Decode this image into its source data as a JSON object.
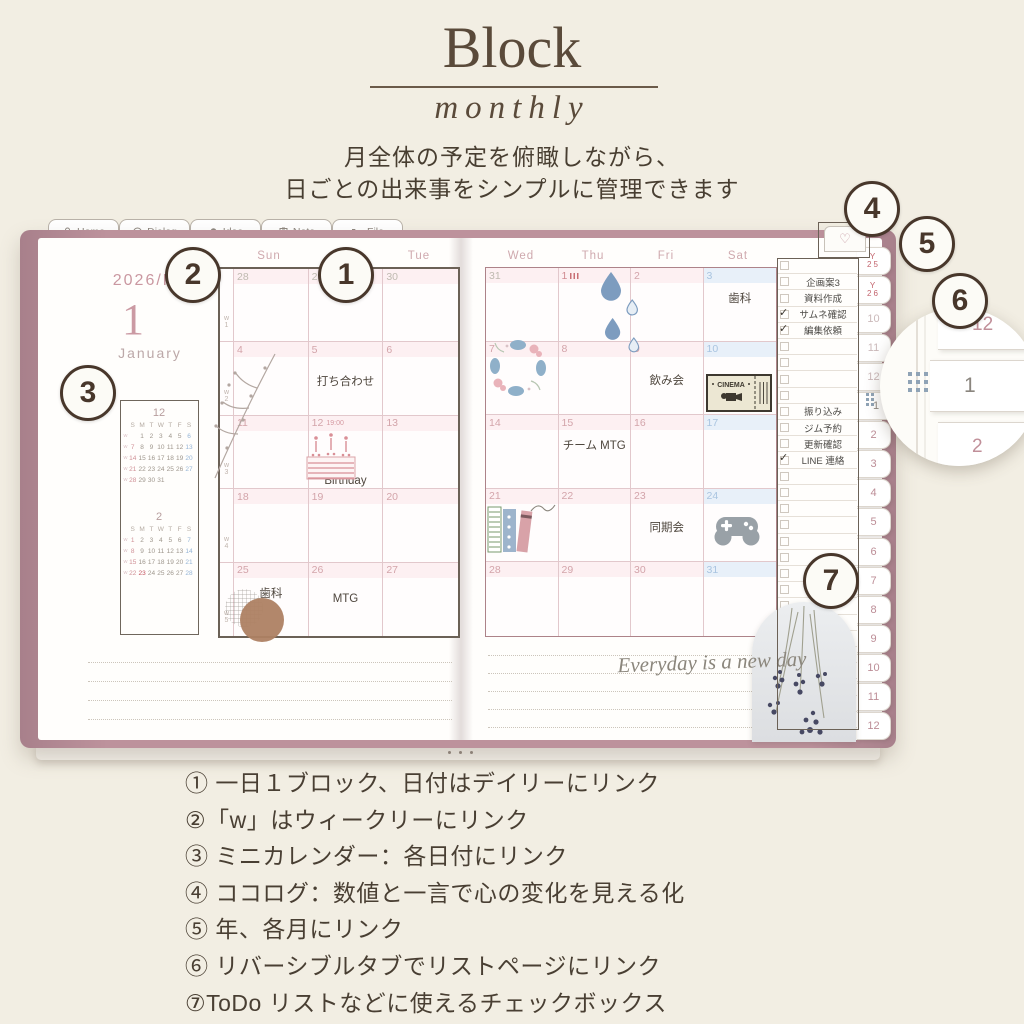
{
  "header": {
    "title": "Block",
    "subtitle": "monthly",
    "desc1": "月全体の予定を俯瞰しながら、",
    "desc2": "日ごとの出来事をシンプルに管理できます"
  },
  "icons": {
    "heart": "♡",
    "check": "✓"
  },
  "planner": {
    "top_tabs": [
      {
        "icon": "clover-icon",
        "label": "Home"
      },
      {
        "icon": "dialog-icon",
        "label": "Dialog"
      },
      {
        "icon": "idea-icon",
        "label": "Idea"
      },
      {
        "icon": "note-icon",
        "label": "Note"
      },
      {
        "icon": "file-icon",
        "label": "File"
      }
    ],
    "left_page": {
      "year": "2026/R8",
      "month_number": "1",
      "month_name": "January",
      "day_headers": [
        "Sun",
        "Mon",
        "Tue"
      ],
      "mini_calendars": [
        {
          "month": "12",
          "day_headers": [
            "S",
            "M",
            "T",
            "W",
            "T",
            "F",
            "S"
          ],
          "weeks": [
            [
              "",
              "1",
              "2",
              "3",
              "4",
              "5",
              "6"
            ],
            [
              "7",
              "8",
              "9",
              "10",
              "11",
              "12",
              "13"
            ],
            [
              "14",
              "15",
              "16",
              "17",
              "18",
              "19",
              "20"
            ],
            [
              "21",
              "22",
              "23",
              "24",
              "25",
              "26",
              "27"
            ],
            [
              "28",
              "29",
              "30",
              "31",
              "",
              "",
              ""
            ]
          ],
          "holidays": []
        },
        {
          "month": "2",
          "day_headers": [
            "S",
            "M",
            "T",
            "W",
            "T",
            "F",
            "S"
          ],
          "weeks": [
            [
              "1",
              "2",
              "3",
              "4",
              "5",
              "6",
              "7"
            ],
            [
              "8",
              "9",
              "10",
              "11",
              "12",
              "13",
              "14"
            ],
            [
              "15",
              "16",
              "17",
              "18",
              "19",
              "20",
              "21"
            ],
            [
              "22",
              "23",
              "24",
              "25",
              "26",
              "27",
              "28"
            ]
          ],
          "holidays": [
            "23"
          ]
        }
      ],
      "weeks": [
        {
          "w": "w1",
          "days": [
            {
              "d": "28",
              "prev": true
            },
            {
              "d": "29",
              "prev": true
            },
            {
              "d": "30",
              "prev": true
            }
          ]
        },
        {
          "w": "w2",
          "days": [
            {
              "d": "4"
            },
            {
              "d": "5",
              "event": "打ち合わせ",
              "pos": "mid"
            },
            {
              "d": "6"
            }
          ]
        },
        {
          "w": "w3",
          "days": [
            {
              "d": "11"
            },
            {
              "d": "12",
              "note": "19:00",
              "event": "Birthday",
              "pos": "bottom"
            },
            {
              "d": "13"
            }
          ]
        },
        {
          "w": "w4",
          "days": [
            {
              "d": "18"
            },
            {
              "d": "19"
            },
            {
              "d": "20"
            }
          ]
        },
        {
          "w": "w5",
          "days": [
            {
              "d": "25",
              "event": "歯科",
              "pos": "hi"
            },
            {
              "d": "26",
              "event": "MTG",
              "pos": "mid"
            },
            {
              "d": "27"
            }
          ]
        }
      ]
    },
    "right_page": {
      "day_headers": [
        "Wed",
        "Thu",
        "Fri",
        "Sat"
      ],
      "weeks": [
        [
          {
            "d": "31",
            "prev": true
          },
          {
            "d": "1",
            "holiday": true
          },
          {
            "d": "2"
          },
          {
            "d": "3",
            "event": "歯科",
            "pos": "hi"
          }
        ],
        [
          {
            "d": "7"
          },
          {
            "d": "8"
          },
          {
            "d": "9",
            "event": "飲み会",
            "pos": "mid"
          },
          {
            "d": "10"
          }
        ],
        [
          {
            "d": "14"
          },
          {
            "d": "15",
            "event": "チーム MTG",
            "pos": "hi"
          },
          {
            "d": "16"
          },
          {
            "d": "17"
          }
        ],
        [
          {
            "d": "21"
          },
          {
            "d": "22"
          },
          {
            "d": "23",
            "event": "同期会",
            "pos": "mid"
          },
          {
            "d": "24"
          }
        ],
        [
          {
            "d": "28"
          },
          {
            "d": "29"
          },
          {
            "d": "30"
          },
          {
            "d": "31"
          }
        ]
      ],
      "note_script": "Everyday is a new day",
      "stickers": {
        "cinema_label": "CINEMA"
      }
    },
    "todo": {
      "total_rows": 29,
      "items": [
        {
          "row": 1,
          "label": "企画案3",
          "checked": false
        },
        {
          "row": 2,
          "label": "資料作成",
          "checked": false
        },
        {
          "row": 3,
          "label": "サムネ確認",
          "checked": true
        },
        {
          "row": 4,
          "label": "編集依頼",
          "checked": true
        },
        {
          "row": 9,
          "label": "振り込み",
          "checked": false
        },
        {
          "row": 10,
          "label": "ジム予約",
          "checked": false
        },
        {
          "row": 11,
          "label": "更新確認",
          "checked": false
        },
        {
          "row": 12,
          "label": "LINE 連絡",
          "checked": true
        }
      ]
    },
    "side_tabs": [
      "Y25",
      "Y26",
      "10",
      "11",
      "12",
      "1",
      "2",
      "3",
      "4",
      "5",
      "6",
      "7",
      "8",
      "9",
      "10",
      "11",
      "12"
    ]
  },
  "magnifier": {
    "tabs": [
      "12",
      "1",
      "2"
    ]
  },
  "annotations": [
    "1",
    "2",
    "3",
    "4",
    "5",
    "6",
    "7"
  ],
  "legend": {
    "items": [
      "① 一日１ブロック、日付はデイリーにリンク",
      "②「w」はウィークリーにリンク",
      "③ ミニカレンダー：各日付にリンク",
      "④ ココログ：数値と一言で心の変化を見える化",
      "⑤ 年、各月にリンク",
      "⑥ リバーシブルタブでリストページにリンク",
      "⑦ToDo リストなどに使えるチェックボックス"
    ]
  }
}
